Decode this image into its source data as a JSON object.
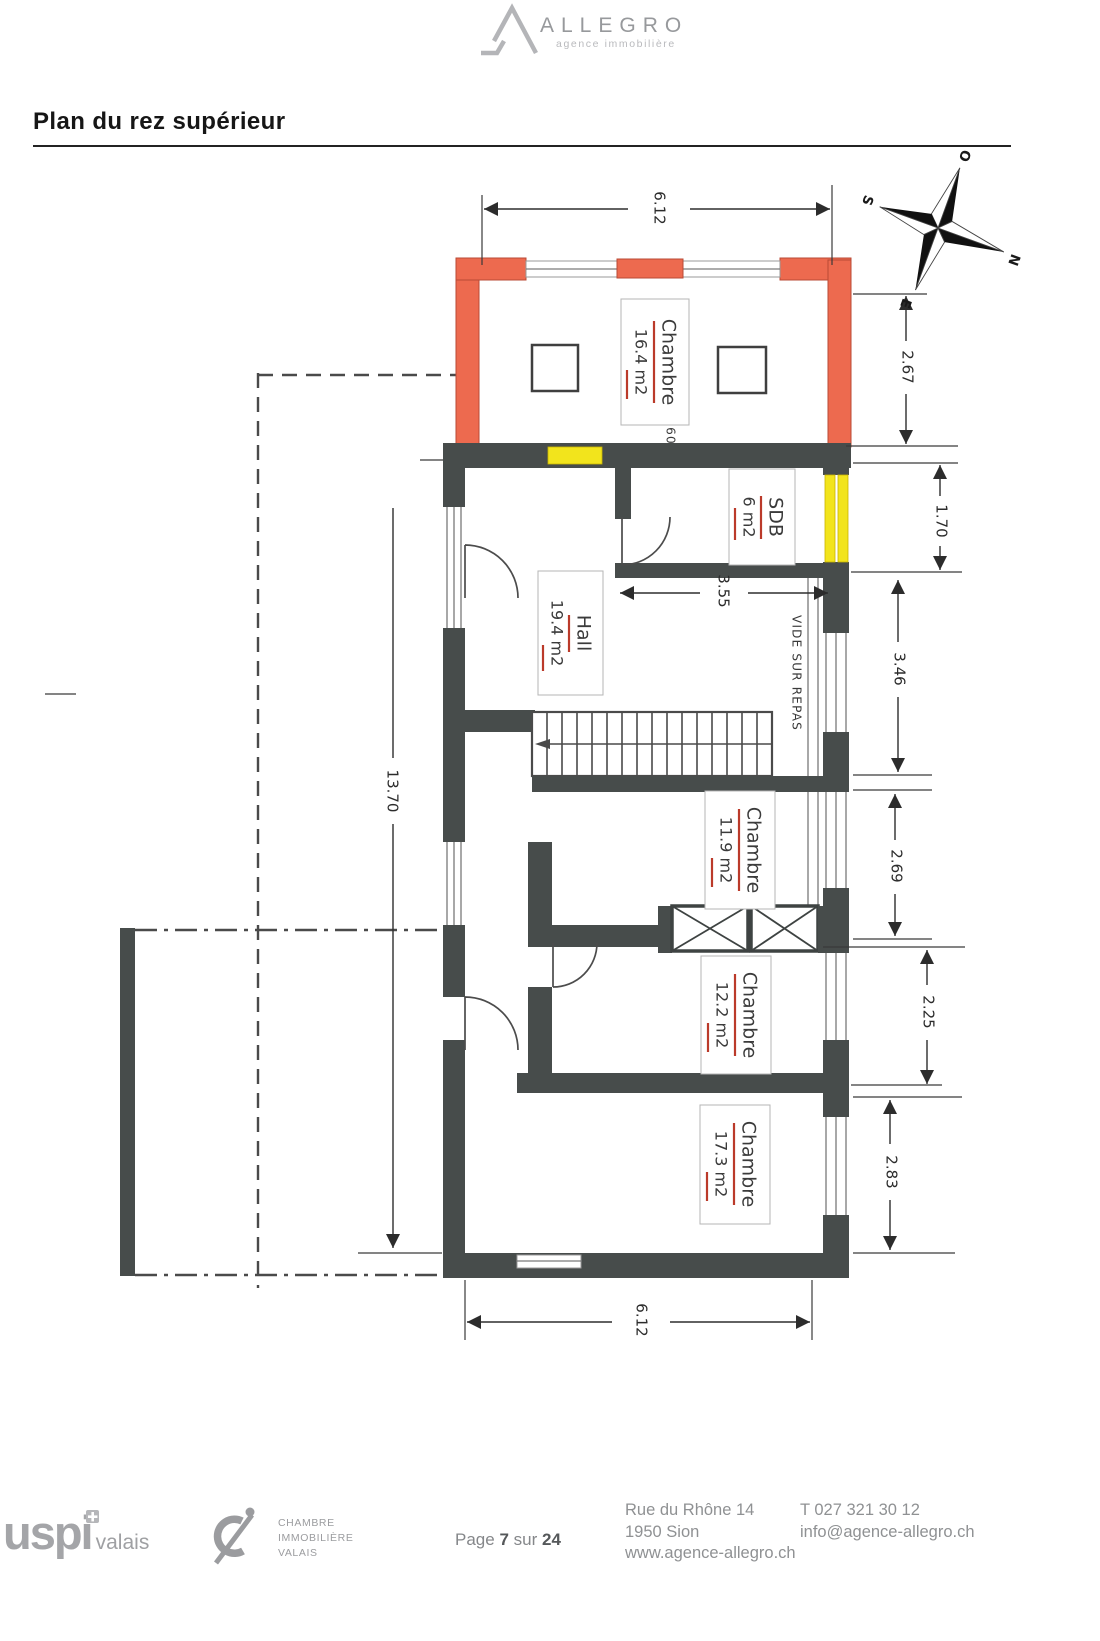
{
  "header": {
    "brand": "ALLEGRO",
    "tagline": "agence immobilière"
  },
  "title": "Plan du rez supérieur",
  "plan": {
    "rooms": [
      {
        "name": "Chambre",
        "area": "16.4 m2"
      },
      {
        "name": "SDB",
        "area": "6 m2"
      },
      {
        "name": "Hall",
        "area": "19.4 m2"
      },
      {
        "name": "Chambre",
        "area": "11.9 m2"
      },
      {
        "name": "Chambre",
        "area": "12.2 m2"
      },
      {
        "name": "Chambre",
        "area": "17.3 m2"
      }
    ],
    "annotations": {
      "vide": "VIDE SUR REPAS",
      "hand": "60"
    },
    "dimensions": {
      "top": "6.12",
      "bottom": "6.12",
      "left": "13.70",
      "hall_width": "3.55",
      "right": [
        "2.67",
        "1.70",
        "3.46",
        "2.69",
        "2.25",
        "2.83"
      ]
    },
    "compass": {
      "top": "O",
      "left": "S",
      "right": "N",
      "bottom": "E"
    },
    "colors": {
      "wall": "#474c4b",
      "new_wall": "#ed6a4f",
      "window_highlight": "#f2e41c",
      "label_underline": "#bb3a2a"
    }
  },
  "footer": {
    "uspi": {
      "main": "uspi",
      "region": "valais"
    },
    "ci": {
      "lines": [
        "CHAMBRE",
        "IMMOBILIÈRE",
        "VALAIS"
      ]
    },
    "page": {
      "prefix": "Page",
      "number": "7",
      "sep": "sur",
      "total": "24"
    },
    "address": [
      "Rue du Rhône 14",
      "1950 Sion",
      "www.agence-allegro.ch"
    ],
    "contact": [
      "T 027 321 30 12",
      "info@agence-allegro.ch"
    ]
  }
}
